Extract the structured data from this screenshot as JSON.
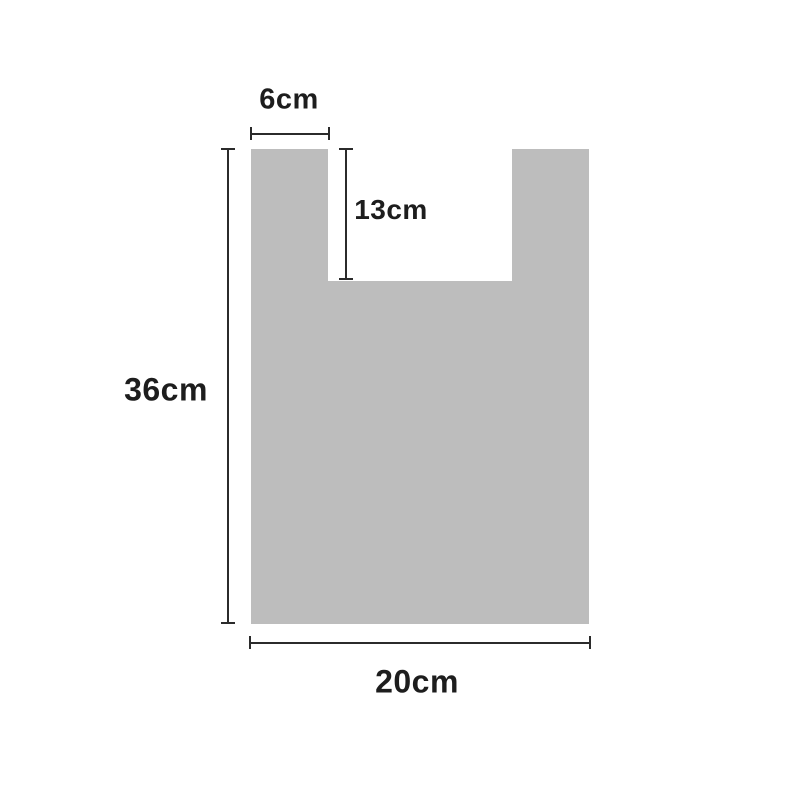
{
  "diagram": {
    "subject": "tote-bag-flat-pattern-with-dimensions",
    "colors": {
      "bag_fill": "#bdbdbd",
      "dimension_line": "#2b2b2b",
      "label_text": "#1d1d1d",
      "page_background": "#ffffff"
    },
    "labels": {
      "handle_width": "6cm",
      "handle_cutout_depth": "13cm",
      "bag_height": "36cm",
      "bag_width": "20cm"
    }
  }
}
